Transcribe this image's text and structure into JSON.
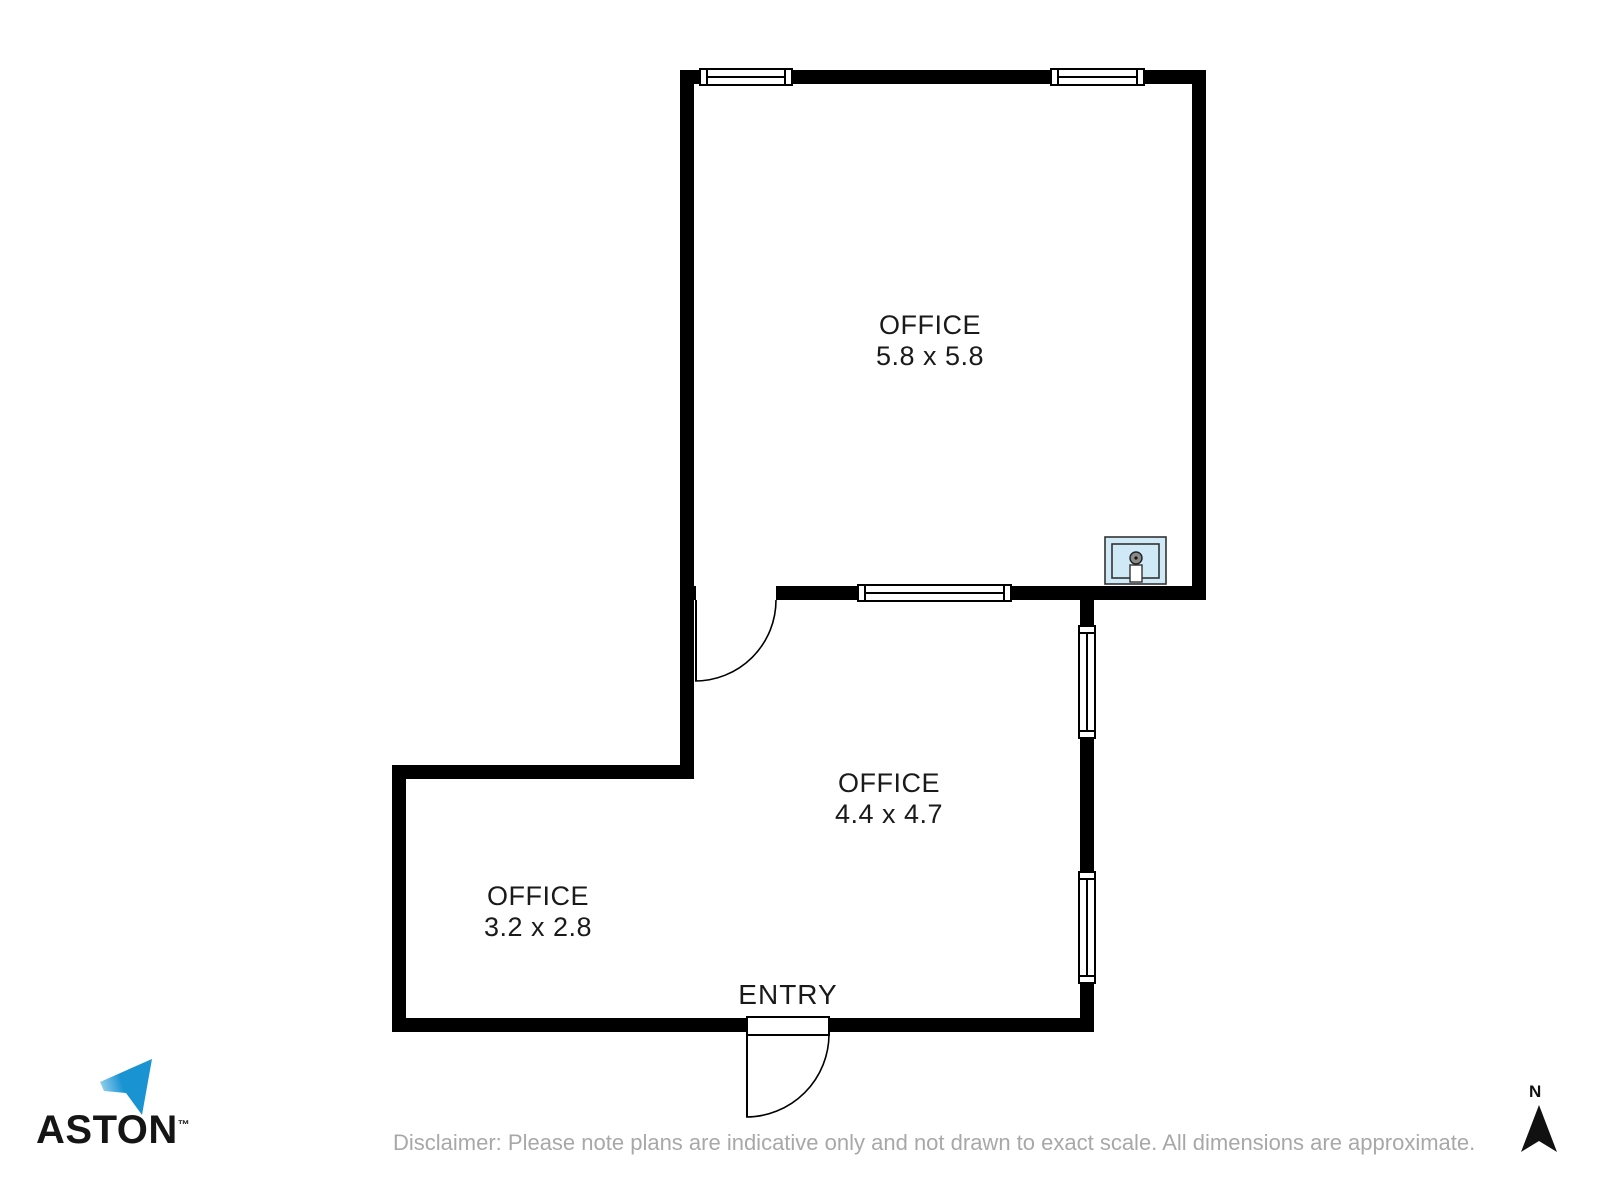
{
  "plan": {
    "rooms": [
      {
        "name": "OFFICE",
        "dims": "5.8 x 5.8"
      },
      {
        "name": "OFFICE",
        "dims": "4.4 x 4.7"
      },
      {
        "name": "OFFICE",
        "dims": "3.2 x 2.8"
      }
    ],
    "entry_label": "ENTRY"
  },
  "branding": {
    "logo_text": "ASTON",
    "trademark": "™",
    "logo_color_light": "#a5d9f0",
    "logo_color_dark": "#1a93d3"
  },
  "compass": {
    "label": "N",
    "arrow_color": "#111111"
  },
  "footer": {
    "disclaimer": "Disclaimer: Please note plans are indicative only and not drawn to exact scale. All dimensions are approximate."
  },
  "colors": {
    "wall": "#000000",
    "sink_fill": "#cfe9f7",
    "label_text": "#1a1a1a",
    "disclaimer_text": "#a8a8a8"
  }
}
